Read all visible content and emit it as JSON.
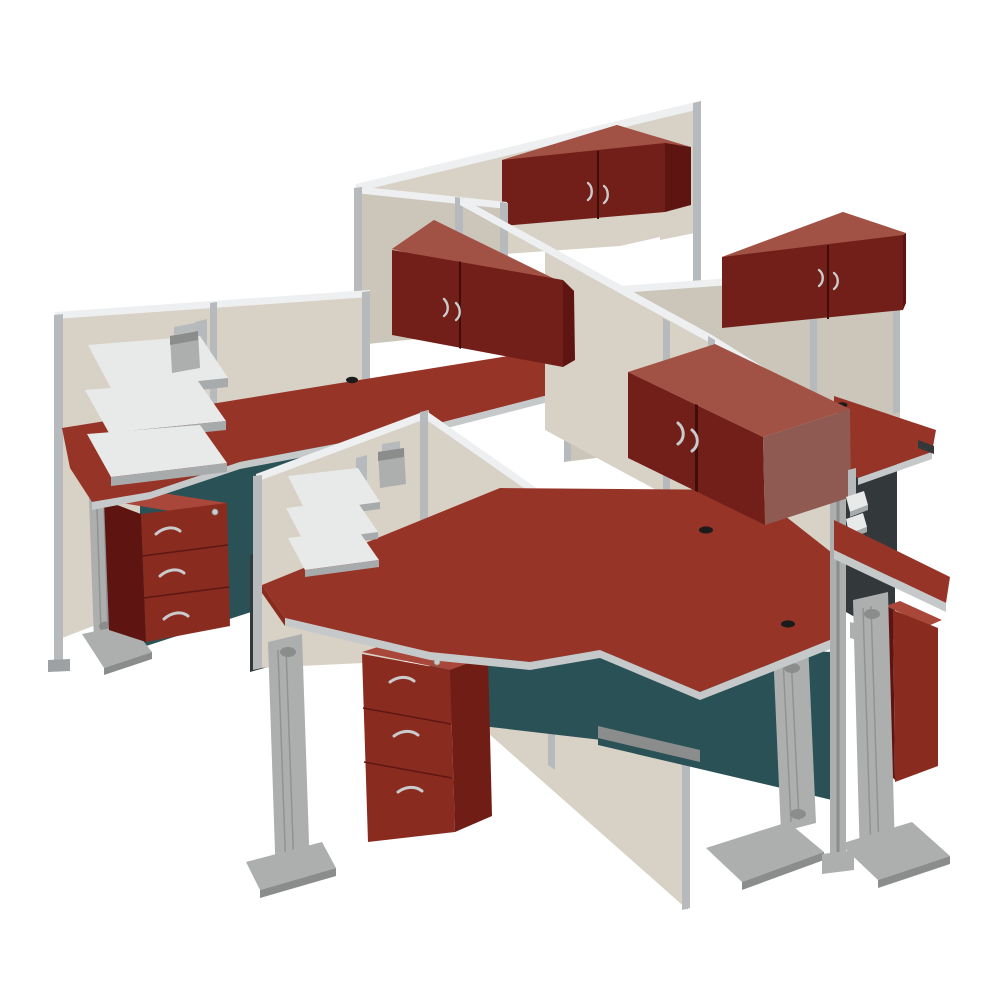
{
  "meta": {
    "type": "product-photograph",
    "subject": "Four-person office cubicle workstation cluster",
    "view": "elevated three-quarter isometric render on seamless white background"
  },
  "scene": {
    "description": "Isometric product render of a 4-person office cubicle cluster: four L-shaped cherry laminate desks arranged pinwheel-style around tan fabric partition panels with silver aluminum frames, each station with a maroon two-door overhead storage hutch, three-drawer mobile file pedestal, hanging three-tier paper trays, pencil cup, teal modesty panels and fluted silver T-legs.",
    "background": "#ffffff",
    "workstation_count": 4,
    "finish": {
      "worksurface": "hansen cherry",
      "storage": "hansen cherry",
      "panel_fabric": "tan",
      "frame": "brushed silver",
      "modesty_panel": "dark teal"
    },
    "components": [
      {
        "name": "overhead-storage-hutch",
        "count": 4,
        "features": [
          "two doors",
          "curved silver pulls",
          "panel mounted"
        ]
      },
      {
        "name": "l-shaped-desk",
        "count": 4,
        "features": [
          "cherry laminate top",
          "black cable grommets",
          "silver edge trim"
        ]
      },
      {
        "name": "three-drawer-mobile-pedestal",
        "count": 3,
        "features": [
          "two box drawers",
          "one file drawer",
          "arc pulls",
          "cylinder lock"
        ]
      },
      {
        "name": "hanging-paper-tray-set",
        "count": 3,
        "features": [
          "three tiers",
          "panel hook bracket"
        ]
      },
      {
        "name": "hanging-pencil-cup",
        "count": 2
      },
      {
        "name": "fabric-partition-panel",
        "count": 10,
        "features": [
          "aluminum posts",
          "bright top cap rail"
        ]
      },
      {
        "name": "fluted-t-leg",
        "count": 5,
        "features": [
          "fluted column",
          "arched cutouts",
          "curved foot"
        ]
      },
      {
        "name": "teal-modesty-panel",
        "count": 3
      },
      {
        "name": "spine-end-post",
        "count": 1
      }
    ]
  },
  "palette": {
    "bg": "#FFFFFF",
    "panel_fabric": "#D8D2C6",
    "panel_fabric_mid": "#CCC6BA",
    "panel_cap": "#EDEFF0",
    "panel_frame": "#B7BABC",
    "panel_frame_dark": "#9EA1A4",
    "cherry_top": "#973428",
    "cherry_top_light": "#A8473A",
    "cherry_front": "#8A2B20",
    "cherry_side": "#5E1511",
    "cherry_side2": "#701D16",
    "hutch_front": "#731F19",
    "hutch_top": "#A25245",
    "hutch_side": "#8E5A52",
    "hutch_seam": "#3F0E0B",
    "modesty_teal": "#2A5156",
    "dark_support": "#33383B",
    "leg_silver": "#ACAFAE",
    "leg_light": "#C9CCCB",
    "leg_dark": "#8A8D8C",
    "edge_trim": "#C6C9CA",
    "tray_white": "#E8EAEA",
    "tray_edge": "#A7ABAC",
    "handle": "#C9CBCC",
    "drawer_line": "#5E1712",
    "grommet": "#1B1B1B"
  }
}
